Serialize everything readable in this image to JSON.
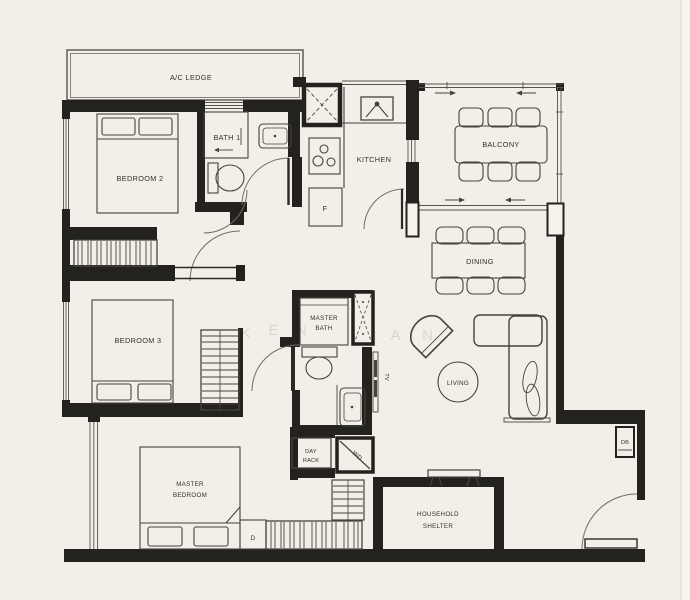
{
  "floorplan": {
    "colors": {
      "background": "#f2efe8",
      "wall": "#23221e",
      "furniture_line": "#45433e",
      "watermark": "#dcd6cb"
    },
    "watermark": {
      "letters": [
        "K",
        "E",
        "N",
        "A",
        "N"
      ]
    },
    "rooms": {
      "ac_ledge": {
        "label": "A/C LEDGE"
      },
      "bedroom2": {
        "label": "BEDROOM 2"
      },
      "bath1": {
        "label": "BATH 1"
      },
      "kitchen": {
        "label": "KITCHEN",
        "fridge_label": "F"
      },
      "balcony": {
        "label": "BALCONY"
      },
      "dining": {
        "label": "DINING"
      },
      "bedroom3": {
        "label": "BEDROOM 3"
      },
      "master_bath": {
        "line1": "MASTER",
        "line2": "BATH"
      },
      "living": {
        "label": "LIVING",
        "tv_label": "TV"
      },
      "master_bedroom": {
        "line1": "MASTER",
        "line2": "BEDROOM",
        "dresser_label": "D"
      },
      "day_rack": {
        "line1": "DAY",
        "line2": "RACK"
      },
      "washer_dryer": {
        "label": "WD"
      },
      "household_shelter": {
        "line1": "HOUSEHOLD",
        "line2": "SHELTER"
      },
      "db": {
        "label": "DB"
      }
    }
  }
}
